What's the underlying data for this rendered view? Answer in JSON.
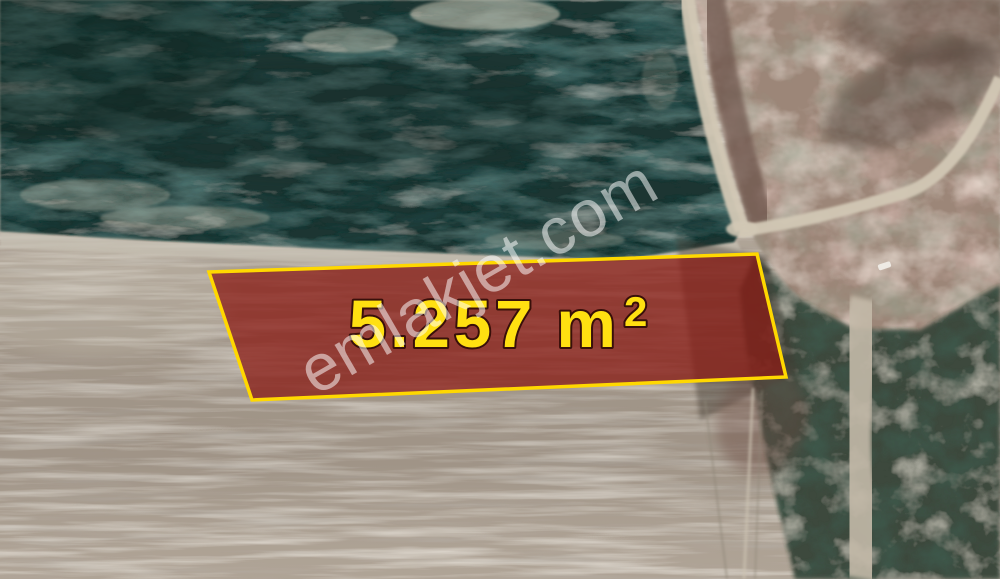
{
  "parcel": {
    "area_label": "5.257 m²",
    "area_value": "5.257",
    "area_unit": "m",
    "area_superscript": "2",
    "fill_color": "#8a1d16",
    "border_color": "#ffd800",
    "label_color": "#ffe011",
    "label_outline_color": "#38100a"
  },
  "watermark": {
    "text": "emlakjet.com",
    "color": "#ffffff"
  },
  "terrain_colors": {
    "forest_green": "#1b3431",
    "field_tan": "#ab9f91",
    "boundary_strip": "#c6c0b3",
    "road_light": "#d2c8b5",
    "road_south": "#c4baa9",
    "rough_track_brown": "#6e574d",
    "scrub_dark": "#3c4a3c",
    "mottled_brown": "#9c8678"
  }
}
